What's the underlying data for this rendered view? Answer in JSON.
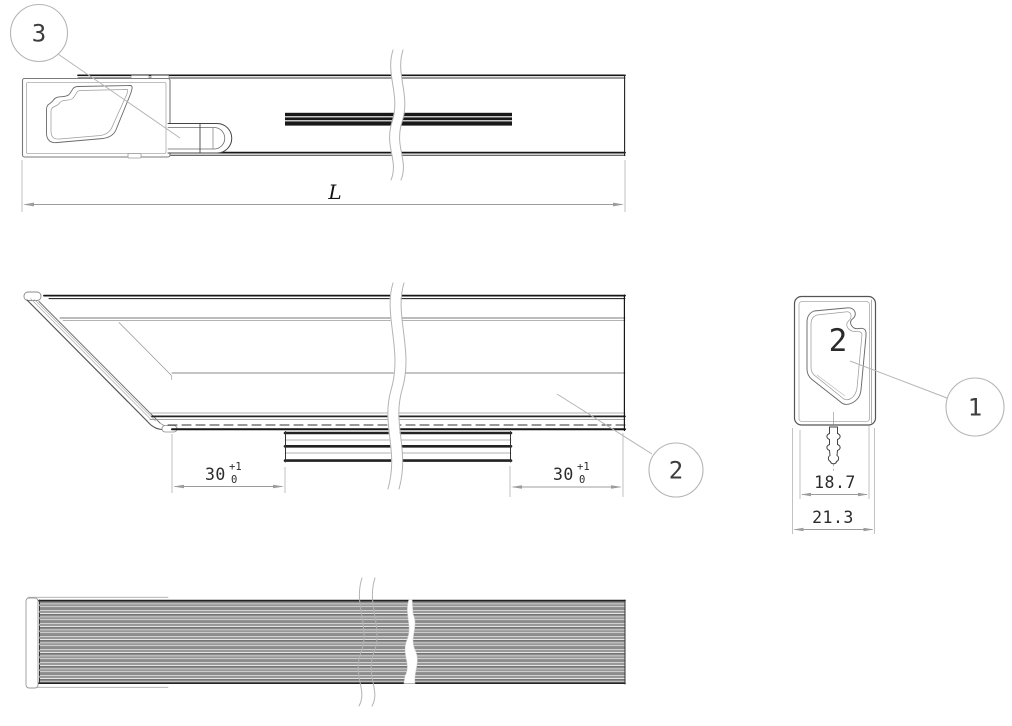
{
  "drawing": {
    "balloons": [
      {
        "label": "3"
      },
      {
        "label": "2"
      },
      {
        "label": "1"
      }
    ],
    "end_view_marking": {
      "label": "2"
    },
    "dimensions": {
      "overall_length": {
        "label": "L"
      },
      "foot_left": {
        "value": "30",
        "tol_upper": "+1",
        "tol_lower": "0"
      },
      "foot_right": {
        "value": "30",
        "tol_upper": "+1",
        "tol_lower": "0"
      },
      "inner_width": {
        "value": "18.7"
      },
      "outer_width": {
        "value": "21.3"
      }
    },
    "colors": {
      "background": "#ffffff",
      "line_dark": "#1a1a1a",
      "line_medium": "#666666",
      "line_light": "#aaaaaa",
      "leader_gray": "#b5b5b5",
      "dimension_gray": "#979797",
      "text_dark": "#2b2b2b",
      "rib_gray": "#8c8c8c",
      "mold_mark_gray": "#b9b9b9"
    }
  }
}
